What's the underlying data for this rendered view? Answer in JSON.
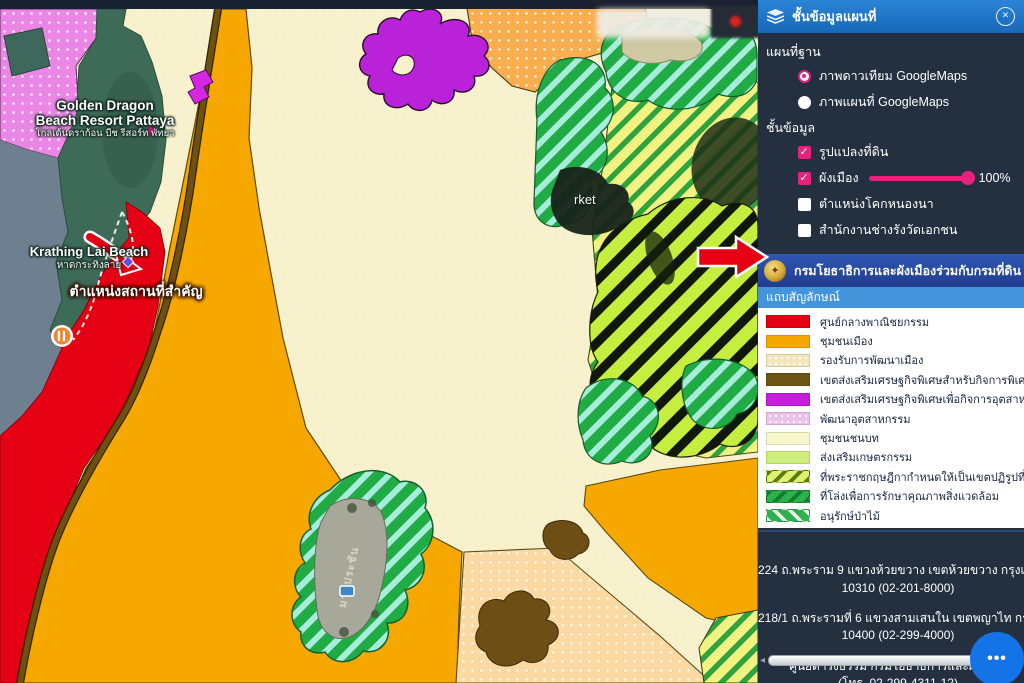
{
  "panel": {
    "header": {
      "title": "ชั้นข้อมูลแผนที่",
      "close_icon": "✕",
      "layers_icon": "layers"
    },
    "base_map": {
      "section_label": "แผนที่ฐาน",
      "options": [
        {
          "label": "ภาพดาวเทียม GoogleMaps",
          "selected": true
        },
        {
          "label": "ภาพแผนที่ GoogleMaps",
          "selected": false
        }
      ]
    },
    "layers": {
      "section_label": "ชั้นข้อมูล",
      "items": [
        {
          "label": "รูปแปลงที่ดิน",
          "checked": true
        },
        {
          "label": "ผังเมือง",
          "checked": true,
          "opacity_value": "100%"
        },
        {
          "label": "ตำแหน่งโคกหนองนา",
          "checked": false
        },
        {
          "label": "สำนักงานช่างรังวัดเอกชน",
          "checked": false
        }
      ]
    },
    "banner": {
      "text": "กรมโยธาธิการและผังเมืองร่วมกับกรมที่ดิน"
    },
    "legend": {
      "title": "แถบสัญลักษณ์",
      "items": [
        {
          "label": "ศูนย์กลางพาณิชยกรรม",
          "color": "#e60013",
          "style": "solid"
        },
        {
          "label": "ชุมชนเมือง",
          "color": "#f6a700",
          "style": "solid"
        },
        {
          "label": "รองรับการพัฒนาเมือง",
          "color": "#f3e6bd",
          "style": "dots"
        },
        {
          "label": "เขตส่งเสริมเศรษฐกิจพิเศษสำหรับกิจการพิเศษ",
          "color": "#6d5414",
          "style": "solid"
        },
        {
          "label": "เขตส่งเสริมเศรษฐกิจพิเศษเพื่อกิจการอุตสาหกรรม",
          "color": "#c51fd9",
          "style": "solid"
        },
        {
          "label": "พัฒนาอุตสาหกรรม",
          "color": "#eec0ec",
          "style": "dots"
        },
        {
          "label": "ชุมชนชนบท",
          "color": "#f8f8cf",
          "style": "solid"
        },
        {
          "label": "ส่งเสริมเกษตรกรรม",
          "color": "#cdee7d",
          "style": "solid"
        },
        {
          "label": "ที่พระราชกฤษฎีกากำหนดให้เป็นเขตปฏิรูปที่ดิน",
          "color": "#dff06e",
          "style": "stripes-olive"
        },
        {
          "label": "ที่โล่งเพื่อการรักษาคุณภาพสิ่งแวดล้อม",
          "color": "#2cb14b",
          "style": "stripes-dark"
        },
        {
          "label": "อนุรักษ์ป่าไม้",
          "color": "#2cb14b",
          "style": "stripes-white"
        }
      ]
    },
    "contact": {
      "lines": [
        "224 ถ.พระราม 9 แขวงห้วยขวาง เขตห้วยขวาง กรุงเทพฯ",
        "10310 (02-201-8000)",
        "218/1 ถ.พระรามที่ 6 แขวงสามเสนใน เขตพญาไท กรุงเทพฯ",
        "10400 (02-299-4000)",
        "ศูนย์ดำรงธรรม กรมโยธาธิการและผังเมือง",
        "(โทร. 02-299-4311-12)",
        "กรมโยธาธิการและผังเมือง"
      ]
    },
    "scrollbar": {
      "left_arrow_icon": "◂"
    },
    "fab_icon": "•••",
    "accent_pink": "#e8217a",
    "header_blue": "#1e78cc",
    "banner_blue": "#27479e",
    "legend_bar_blue": "#4494dc"
  },
  "map": {
    "labels": {
      "resort_line1": "Golden Dragon",
      "resort_line2": "Beach Resort Pattaya",
      "resort_thai": "โกลเด้นดราก้อน บีช รีสอร์ท พัทยา",
      "beach_en": "Krathing Lai Beach",
      "beach_thai": "หาดกระทิงลาย",
      "important_place": "ตำแหน่งสถานที่สำคัญ",
      "market_partial": "rket",
      "reservoir": "มาบประชัน"
    }
  }
}
